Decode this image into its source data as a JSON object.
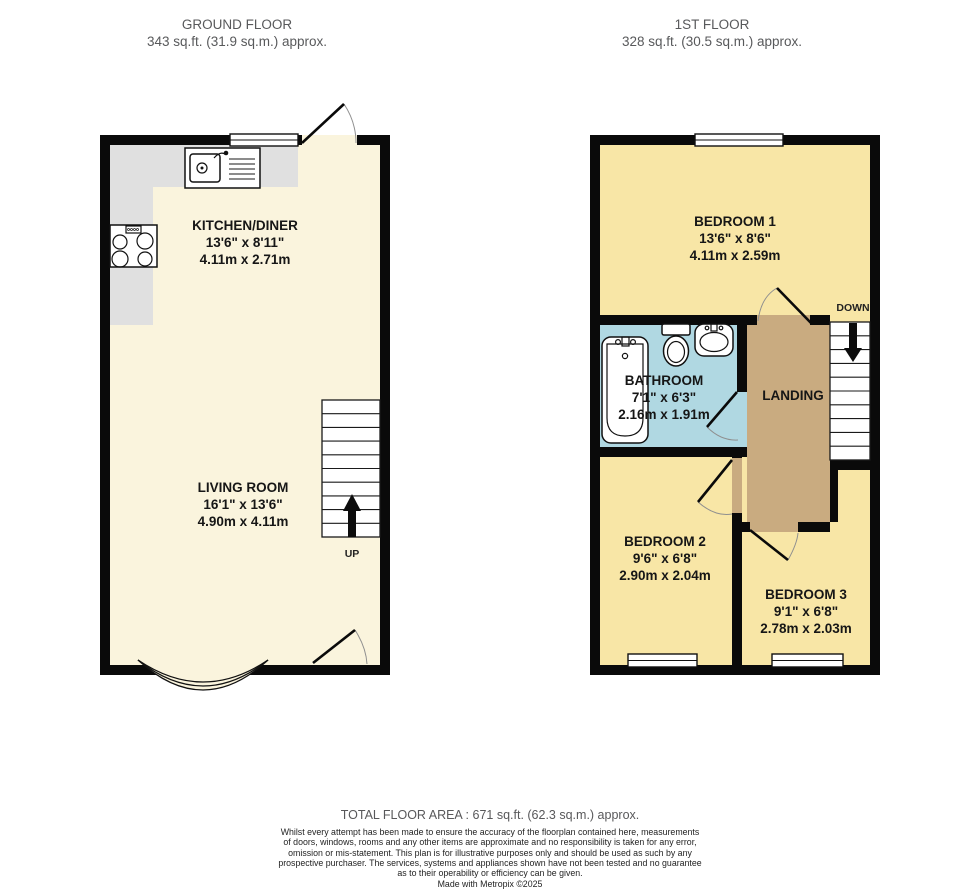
{
  "colors": {
    "wall": "#0a0a0a",
    "ground_floor_fill": "#faf4dd",
    "counter_gray": "#e0e0e0",
    "bedroom_yellow": "#f8e6a6",
    "bathroom_blue": "#b0d8e2",
    "landing_tan": "#c9ab80",
    "header_text": "#58595b",
    "label_text": "#161616"
  },
  "ground_floor": {
    "title": "GROUND FLOOR",
    "area": "343 sq.ft. (31.9 sq.m.) approx.",
    "stairs_label": "UP",
    "rooms": {
      "kitchen": {
        "name": "KITCHEN/DINER",
        "dims_imperial": "13'6\"  x 8'11\"",
        "dims_metric": "4.11m  x 2.71m"
      },
      "living": {
        "name": "LIVING ROOM",
        "dims_imperial": "16'1\"  x 13'6\"",
        "dims_metric": "4.90m  x 4.11m"
      }
    }
  },
  "first_floor": {
    "title": "1ST FLOOR",
    "area": "328 sq.ft. (30.5 sq.m.) approx.",
    "stairs_label": "DOWN",
    "rooms": {
      "bedroom1": {
        "name": "BEDROOM 1",
        "dims_imperial": "13'6\"  x 8'6\"",
        "dims_metric": "4.11m  x 2.59m"
      },
      "bathroom": {
        "name": "BATHROOM",
        "dims_imperial": "7'1\"  x 6'3\"",
        "dims_metric": "2.16m  x 1.91m"
      },
      "landing": {
        "name": "LANDING"
      },
      "bedroom2": {
        "name": "BEDROOM 2",
        "dims_imperial": "9'6\"  x 6'8\"",
        "dims_metric": "2.90m  x 2.04m"
      },
      "bedroom3": {
        "name": "BEDROOM 3",
        "dims_imperial": "9'1\"  x 6'8\"",
        "dims_metric": "2.78m  x 2.03m"
      }
    }
  },
  "footer": {
    "total_area": "TOTAL FLOOR AREA : 671 sq.ft. (62.3 sq.m.) approx.",
    "disclaimer_lines": [
      "Whilst every attempt has been made to ensure the accuracy of the floorplan contained here, measurements",
      "of doors, windows, rooms and any other items are approximate and no responsibility is taken for any error,",
      "omission or mis-statement. This plan is for illustrative purposes only and should be used as such by any",
      "prospective purchaser. The services, systems and appliances shown have not been tested and no guarantee",
      "as to their operability or efficiency can be given."
    ],
    "credit": "Made with Metropix ©2025"
  }
}
